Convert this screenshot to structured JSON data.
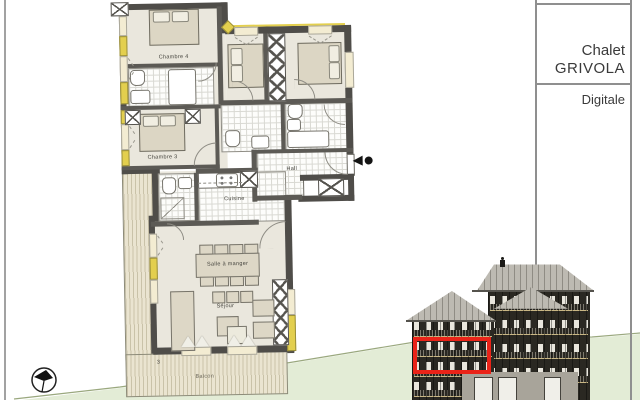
{
  "title_block": {
    "line1": "Chalet",
    "line2": "GRIVOLA",
    "line3": "Digitale"
  },
  "plan": {
    "rooms": {
      "chambre4": "Chambre 4",
      "chambre3": "Chambre 3",
      "hall": "Hall",
      "cuisine": "Cuisine",
      "salle_a_manger": "Salle à manger",
      "sejour": "Séjour",
      "balcon": "Balcon"
    },
    "misc_label_3": "3"
  },
  "colors": {
    "wall": "#4f4d49",
    "floor_beige": "#eae7dd",
    "accent_yellow": "#e3cf4e",
    "window_cream": "#f3ecd2",
    "deck_wood": "#eae4d0",
    "hill_green": "#e3ecd6",
    "hill_line": "#9aa87e",
    "red_highlight": "#ea2318",
    "building_dark": "#2a2822",
    "roof_gray": "#bdbab2"
  },
  "icons": {
    "north_arrow": "compass-north-arrow",
    "entry_marker": "entry-direction-triangle-dot"
  }
}
